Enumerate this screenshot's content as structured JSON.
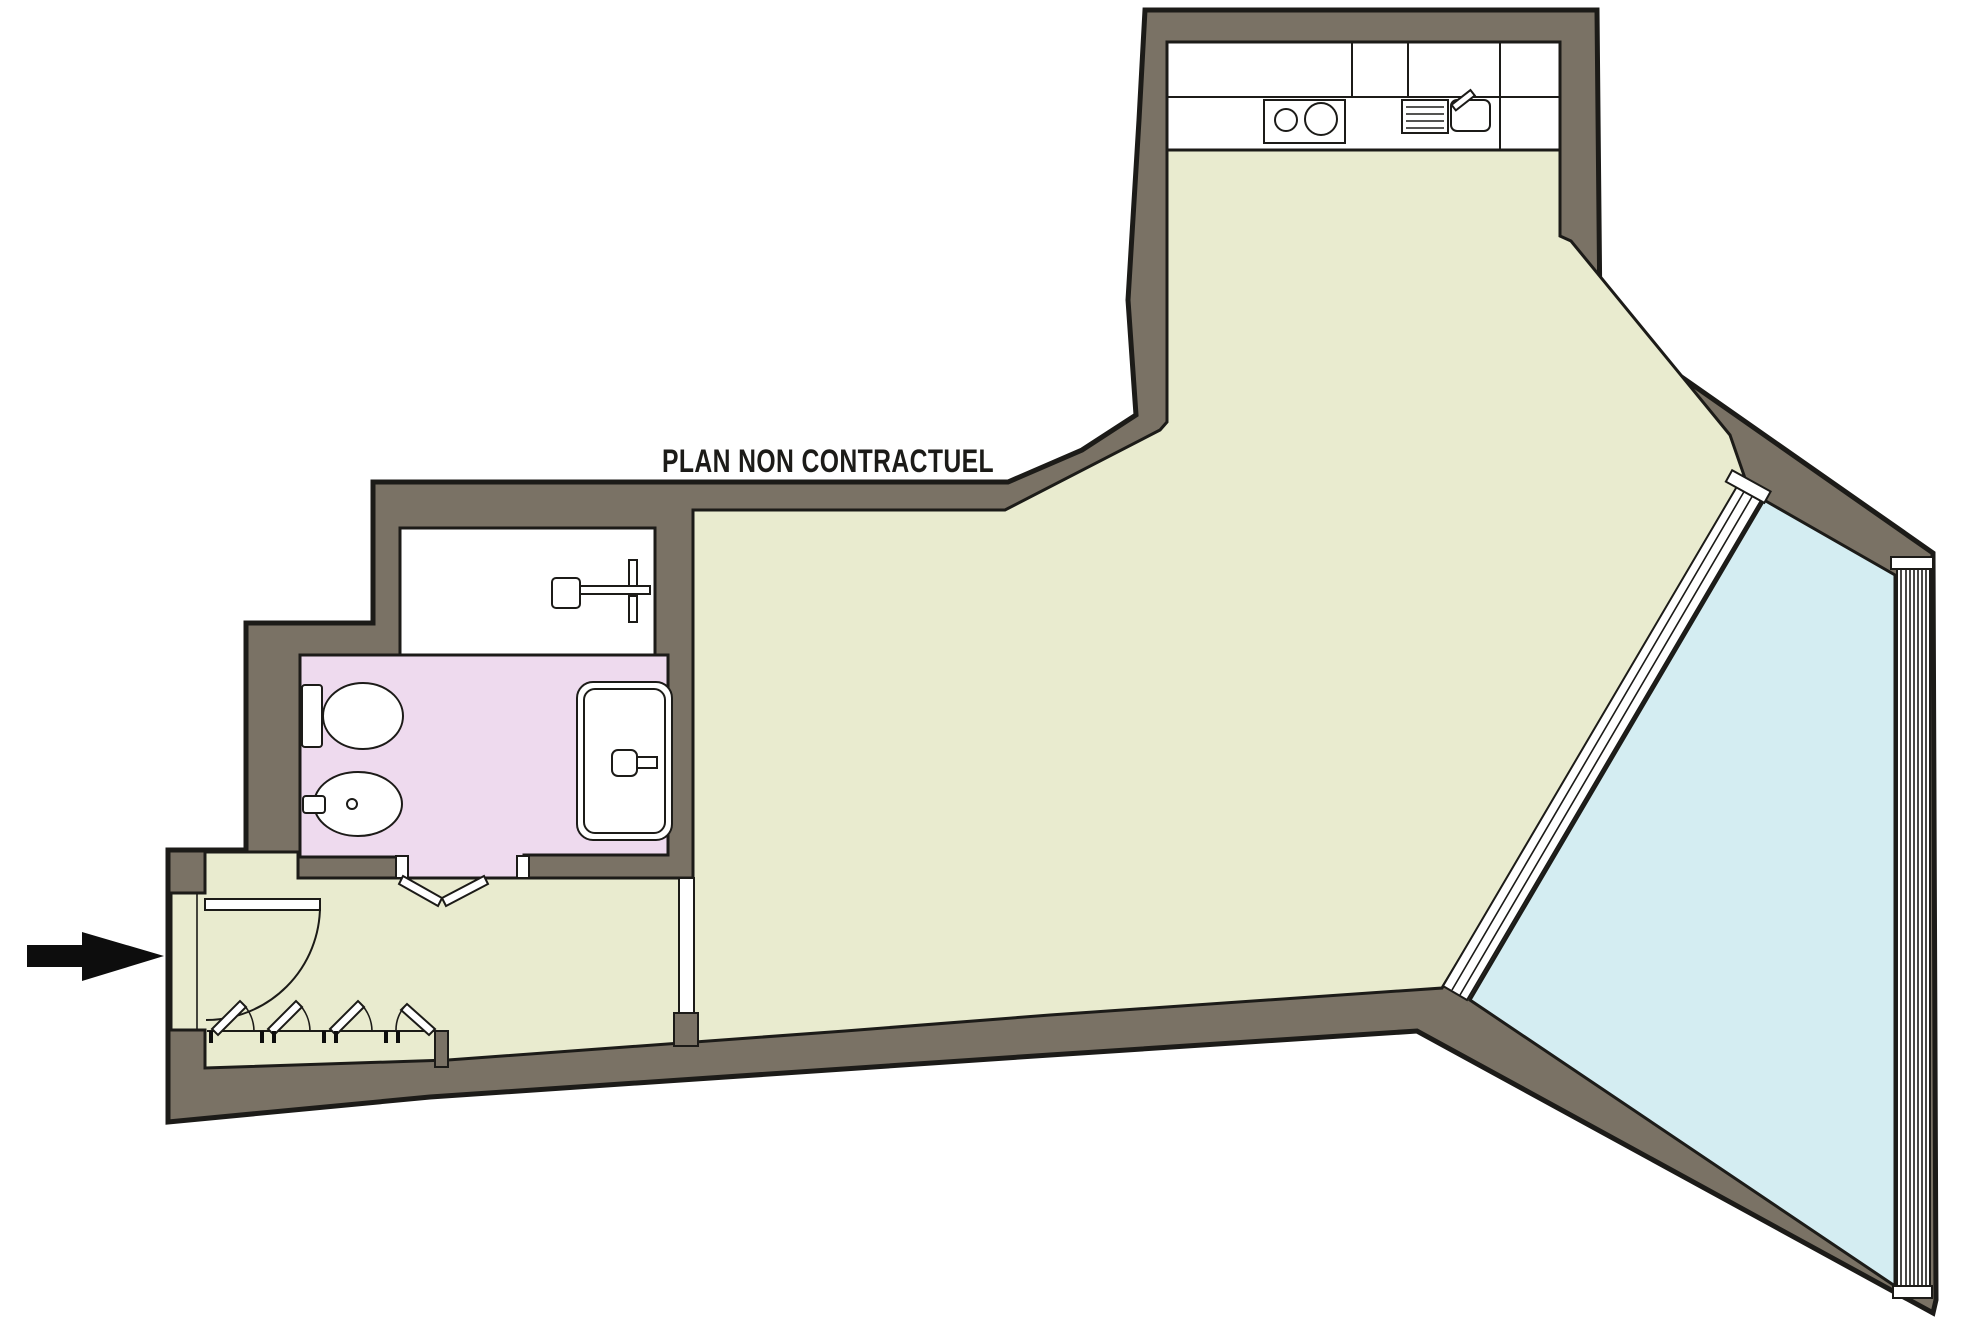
{
  "title": {
    "text": "PLAN NON CONTRACTUEL"
  },
  "colors": {
    "background": "#ffffff",
    "wall": "#7a7265",
    "outline": "#1c1b18",
    "floor": "#e9ebcf",
    "bathroom": "#eedaee",
    "terrace": "#d4edf2",
    "fixture": "#ffffff",
    "arrow": "#0d0d0d"
  }
}
